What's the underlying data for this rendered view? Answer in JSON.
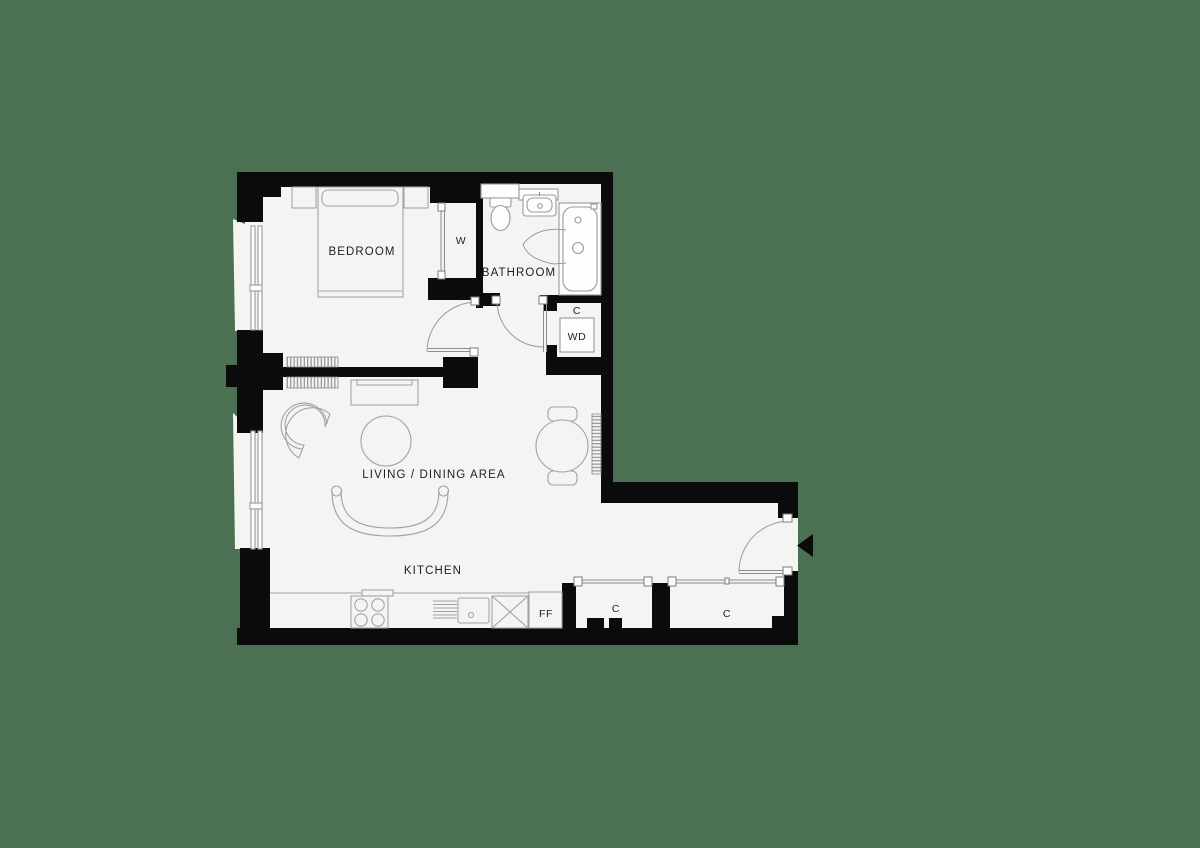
{
  "canvas": {
    "width": 1200,
    "height": 848,
    "background_color": "#4b7152",
    "floor_color": "#f4f4f2",
    "wall_color": "#0b0b0b",
    "furniture_line_color": "#a3a3a3",
    "text_color": "#1f1f1f"
  },
  "labels": {
    "bedroom": "BEDROOM",
    "wardrobe": "W",
    "bathroom": "BATHROOM",
    "cupboard_top": "C",
    "washer_dryer": "WD",
    "living_dining": "LIVING / DINING AREA",
    "kitchen": "KITCHEN",
    "fridge_freezer": "FF",
    "cupboard_hall_left": "C",
    "cupboard_hall_right": "C"
  },
  "rooms": [
    {
      "name": "Bedroom"
    },
    {
      "name": "Bathroom"
    },
    {
      "name": "Living / Dining Area"
    },
    {
      "name": "Kitchen"
    },
    {
      "name": "Hallway"
    }
  ],
  "features": [
    "double bed with two nightstands",
    "sliding-door wardrobe W",
    "bathroom with toilet, basin, bathtub",
    "utility cupboard C with washer-dryer WD",
    "armchair, side table, curved sofa, TV unit",
    "round dining table with two chairs",
    "kitchen run with hob, sink, appliance, fridge-freezer FF",
    "two hall storage cupboards C",
    "entrance door with entry arrow on right side",
    "two windows on left wall",
    "three radiators"
  ]
}
